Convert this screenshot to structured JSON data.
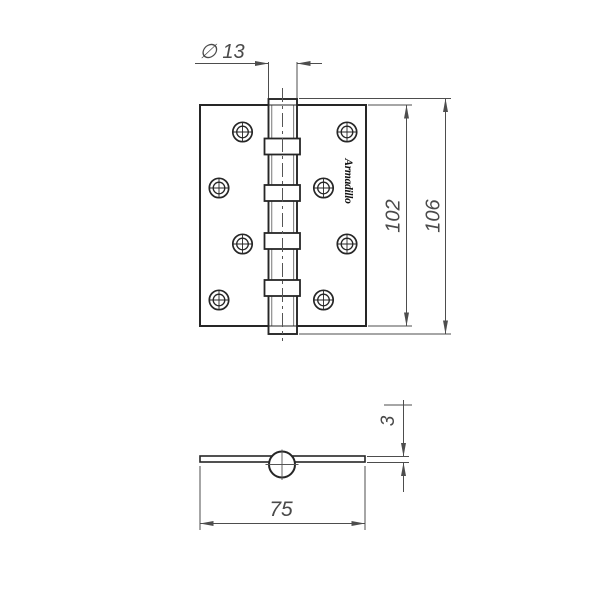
{
  "drawing": {
    "brand": "Armadillo",
    "dimensions": {
      "pin_diameter": "∅ 13",
      "leaf_height": "102",
      "overall_height": "106",
      "leaf_thickness": "3",
      "open_width": "75"
    },
    "colors": {
      "background": "#ffffff",
      "object_line": "#262626",
      "dimension_line": "#4d4d4d",
      "dimension_text": "#4a4a4a"
    }
  }
}
